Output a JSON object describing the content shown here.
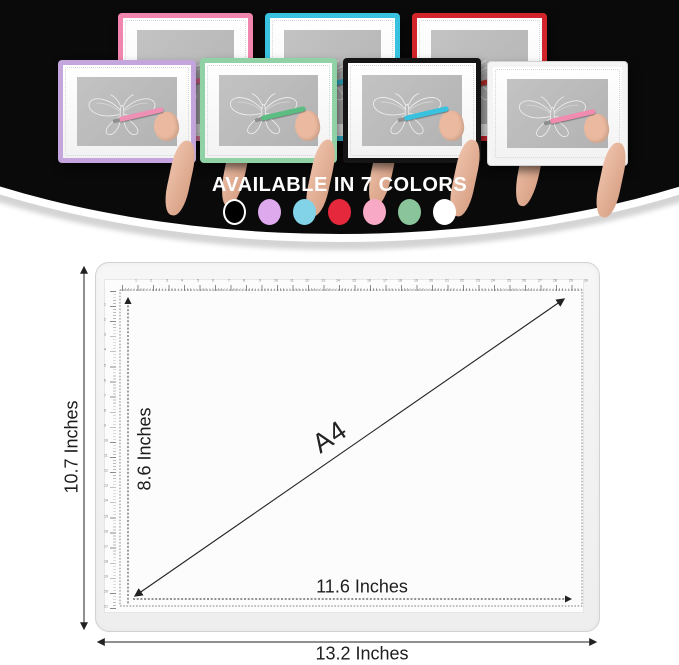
{
  "hero": {
    "heading": "AVAILABLE IN 7 COLORS",
    "pads": [
      {
        "name": "pink",
        "row": "back",
        "frame_color": "#f285ae",
        "pen_color": "#ee6f9d"
      },
      {
        "name": "blue",
        "row": "back",
        "frame_color": "#38c2df",
        "pen_color": "#38c2df"
      },
      {
        "name": "red",
        "row": "back",
        "frame_color": "#d3242c",
        "pen_color": "#c9342d"
      },
      {
        "name": "purple",
        "row": "front",
        "frame_color": "#c4a5de",
        "pen_color": "#ee8fb4"
      },
      {
        "name": "green",
        "row": "front",
        "frame_color": "#90d1a6",
        "pen_color": "#5cbd82"
      },
      {
        "name": "black",
        "row": "front",
        "frame_color": "#151515",
        "pen_color": "#38c2df"
      },
      {
        "name": "white",
        "row": "front",
        "frame_color": "#f4f4f4",
        "pen_color": "#f18bb0"
      }
    ],
    "color_dots": [
      {
        "name": "black",
        "fill": "#000000",
        "ring": "#ffffff"
      },
      {
        "name": "purple",
        "fill": "#dfa9ee",
        "ring": ""
      },
      {
        "name": "blue",
        "fill": "#82d2e8",
        "ring": ""
      },
      {
        "name": "red",
        "fill": "#e6283c",
        "ring": ""
      },
      {
        "name": "pink",
        "fill": "#f8a9c5",
        "ring": ""
      },
      {
        "name": "green",
        "fill": "#8ac49a",
        "ring": ""
      },
      {
        "name": "white",
        "fill": "#ffffff",
        "ring": ""
      }
    ]
  },
  "diagram": {
    "device_label": "A4",
    "outer_height_label": "10.7 Inches",
    "outer_width_label": "13.2 Inches",
    "inner_height_label": "8.6 Inches",
    "inner_width_label": "11.6 Inches",
    "ruler_top_numbers": [
      1,
      2,
      3,
      4,
      5,
      6,
      7,
      8,
      9,
      10,
      11,
      12,
      13,
      14,
      15,
      16,
      17,
      18,
      19,
      20,
      21,
      22,
      23,
      24,
      25,
      26,
      27,
      28,
      29,
      30
    ],
    "ruler_left_numbers": [
      1,
      2,
      3,
      4,
      5,
      6,
      7,
      8,
      9,
      10,
      11,
      12,
      13,
      14,
      15,
      16,
      17,
      18,
      19,
      20,
      21
    ]
  }
}
